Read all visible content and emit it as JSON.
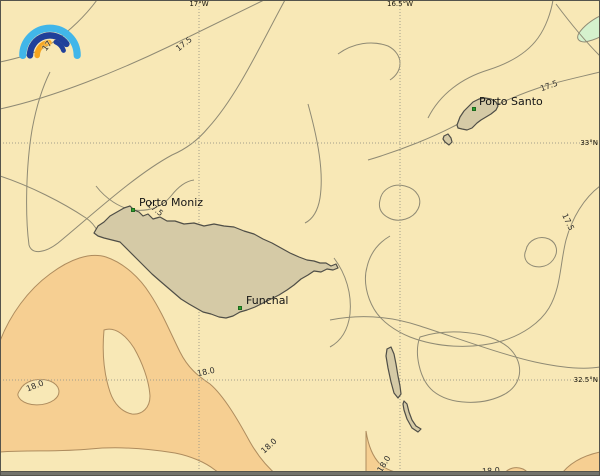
{
  "window": {
    "border_color": "#55544c",
    "bottom_bar_color": "#73736b"
  },
  "map": {
    "type": "sea-surface-temperature-contour-map",
    "region": "Madeira archipelago",
    "colors": {
      "sea": "#f8e8b6",
      "warm_band_18": "#f6cf92",
      "cool_patch": "#d5f1cd",
      "land": "#d5caa6",
      "land_border": "#4f4e47",
      "contour_line": "#8f8a74",
      "warm_band_edge": "#ae8c5e",
      "grid_line": "#a29e8a",
      "town_dot": "#2f9e2f",
      "label_text": "#2b2b2b"
    },
    "logo": {
      "name": "rainbow-weather-logo",
      "colors": {
        "outer_arc": "#41b6e9",
        "mid_arc": "#20409a",
        "inner_arc": "#f6a51f"
      }
    },
    "grid": {
      "meridians": [
        {
          "label": "17°W",
          "x": 199
        },
        {
          "label": "16.5°W",
          "x": 400
        }
      ],
      "parallels": [
        {
          "label": "33°N",
          "y": 143
        },
        {
          "label": "32.5°N",
          "y": 380
        }
      ]
    },
    "places": [
      {
        "name": "Porto Santo",
        "x": 474,
        "y": 109,
        "lx": 479,
        "ly": 96
      },
      {
        "name": "Porto Moniz",
        "x": 133,
        "y": 210,
        "lx": 139,
        "ly": 197
      },
      {
        "name": "Funchal",
        "x": 240,
        "y": 308,
        "lx": 246,
        "ly": 295
      }
    ],
    "isotherm_values": [
      17,
      17.5,
      18
    ],
    "contour_labels": [
      {
        "text": "17",
        "x": 47,
        "y": 46,
        "rot": -52
      },
      {
        "text": "17.5",
        "x": 184,
        "y": 44,
        "rot": -38
      },
      {
        "text": "17.5",
        "x": 549,
        "y": 86,
        "rot": -20
      },
      {
        "text": "17.5",
        "x": 568,
        "y": 222,
        "rot": 65
      },
      {
        "text": "17.5",
        "x": 155,
        "y": 209,
        "rot": 38
      },
      {
        "text": "18.0",
        "x": 35,
        "y": 386,
        "rot": -22
      },
      {
        "text": "18.0",
        "x": 206,
        "y": 372,
        "rot": -12
      },
      {
        "text": "18.0",
        "x": 269,
        "y": 446,
        "rot": -42
      },
      {
        "text": "18.0",
        "x": 384,
        "y": 464,
        "rot": -58
      },
      {
        "text": "18.0",
        "x": 491,
        "y": 471,
        "rot": -5
      }
    ]
  }
}
